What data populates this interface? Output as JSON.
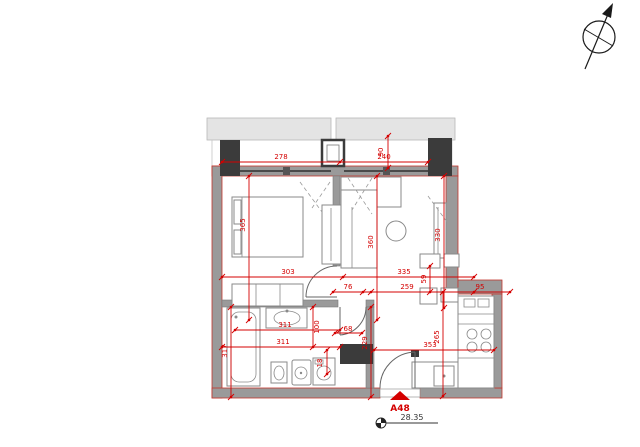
{
  "plan": {
    "unit_label": "A48",
    "area_level": "28.35",
    "colors": {
      "dimension_red": "#d40000",
      "wall_gray": "#9a9a9a",
      "dark_wall": "#3b3b3b"
    },
    "markers": {
      "north_arrow": "north-arrow",
      "entrance": "entrance-triangle",
      "level": "level-marker"
    },
    "dimensions": {
      "top_left": "278",
      "top_right": "240",
      "top_niche_depth": "90",
      "bedroom_depth": "365",
      "bedroom_width": "303",
      "living_depth": "360",
      "living_width": "335",
      "living_right_depth": "330",
      "step_depth": "59",
      "door_clearance": "76",
      "hall_span": "259",
      "niche_width": "95",
      "bath_depth": "317",
      "bath_width_top": "311",
      "bath_width_bottom": "311",
      "bath_partition": "100",
      "bath_door": "68",
      "washer_gap": "18",
      "hall_depth": "229",
      "kitchen_width": "353",
      "kitchen_depth": "265"
    }
  }
}
